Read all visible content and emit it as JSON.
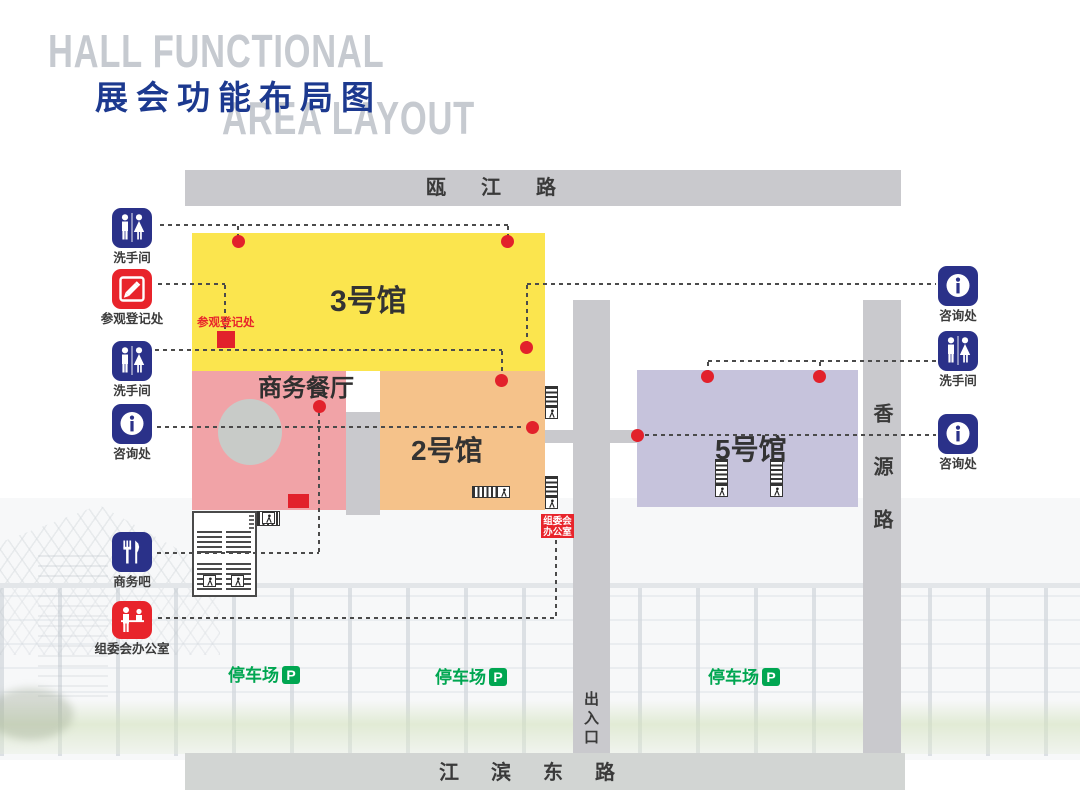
{
  "title": {
    "line1_en": "HALL FUNCTIONAL",
    "line2_zh": "展会功能布局图",
    "line3_en": "AREA LAYOUT"
  },
  "roads": {
    "top": "瓯江路",
    "right": "香源路",
    "bottom": "江滨东路",
    "gate": "出入口"
  },
  "halls": {
    "hall3": {
      "label": "3号馆",
      "color": "#fbe54e"
    },
    "hall2": {
      "label": "2号馆",
      "color": "#f5c28a"
    },
    "hall5": {
      "label": "5号馆",
      "color": "#c6c3dc"
    },
    "restaurant": {
      "label": "商务餐厅",
      "color": "#f1a3a7"
    }
  },
  "legend_left": [
    {
      "icon": "restroom-icon",
      "label": "洗手间"
    },
    {
      "icon": "registration-icon",
      "label": "参观登记处"
    },
    {
      "icon": "restroom-icon",
      "label": "洗手间"
    },
    {
      "icon": "info-icon",
      "label": "咨询处"
    },
    {
      "icon": "food-icon",
      "label": "商务吧"
    },
    {
      "icon": "office-icon",
      "label": "组委会办公室"
    }
  ],
  "legend_right": [
    {
      "icon": "info-icon",
      "label": "咨询处"
    },
    {
      "icon": "restroom-icon",
      "label": "洗手间"
    },
    {
      "icon": "info-icon",
      "label": "咨询处"
    }
  ],
  "annotations": {
    "registration_point": "参观登记处",
    "office_line1": "组委会",
    "office_line2": "办公室"
  },
  "parking": {
    "label": "停车场",
    "badge": "P"
  },
  "colors": {
    "road": "#c9c9cd",
    "marker_red": "#e2212b",
    "icon_blue": "#2a3189",
    "icon_red": "#e8242b",
    "parking_green": "#00a651",
    "title_blue": "#1c398f",
    "title_gray": "#c6cad0",
    "dashed_line": "#4b4b4b"
  }
}
